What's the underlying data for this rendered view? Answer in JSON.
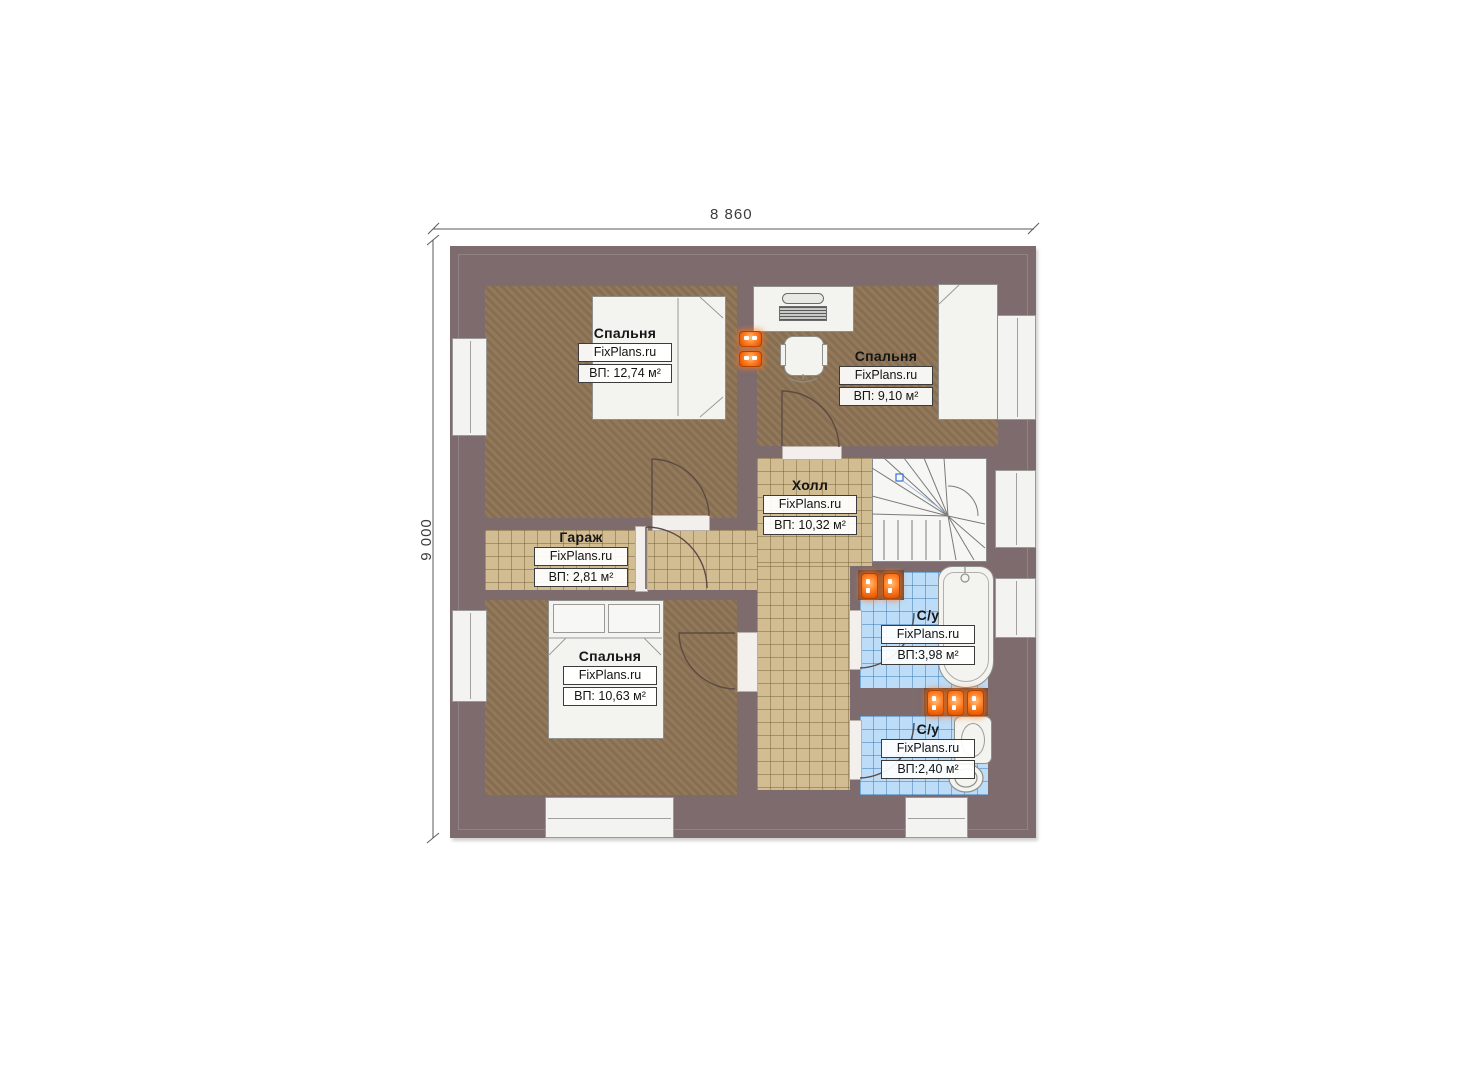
{
  "dimensions": {
    "width_label": "8 860",
    "height_label": "9 000"
  },
  "rooms": {
    "bedroom1": {
      "name": "Спальня",
      "brand": "FixPlans.ru",
      "area": "ВП: 12,74 м²"
    },
    "bedroom2": {
      "name": "Спальня",
      "brand": "FixPlans.ru",
      "area": "ВП: 9,10 м²"
    },
    "hall": {
      "name": "Холл",
      "brand": "FixPlans.ru",
      "area": "ВП: 10,32 м²"
    },
    "garage": {
      "name": "Гараж",
      "brand": "FixPlans.ru",
      "area": "ВП: 2,81 м²"
    },
    "bedroom3": {
      "name": "Спальня",
      "brand": "FixPlans.ru",
      "area": "ВП: 10,63 м²"
    },
    "bath1": {
      "name": "С/у",
      "brand": "FixPlans.ru",
      "area": "ВП:3,98 м²"
    },
    "bath2": {
      "name": "С/у",
      "brand": "FixPlans.ru",
      "area": "ВП:2,40 м²"
    }
  },
  "colors": {
    "wall": "#7d6b6d",
    "carpet": "#8d7355",
    "tile_beige": "#d2bd92",
    "tile_blue": "#bcdcf7",
    "radiator": "#ff7a1f"
  }
}
